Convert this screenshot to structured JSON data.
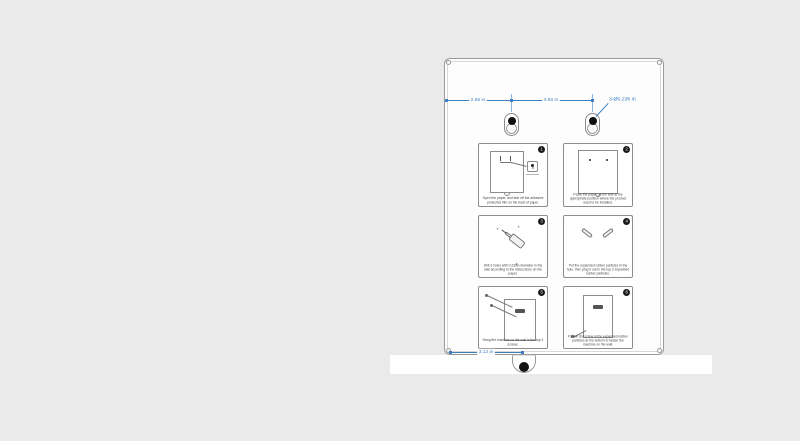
{
  "colors": {
    "page-bg": "#eaeaea",
    "dimension-blue": "#3d7fc1",
    "sheet-border": "#9a9a9a"
  },
  "drawing": {
    "dimensions": {
      "left_spacing": "2.55 in",
      "center_spacing": "3.50 in",
      "hole_callout": "3-Ø0.236 in",
      "bottom_offset": "3.12 in"
    },
    "panels": [
      {
        "number": "1",
        "caption": "Open the paper, and tear off the adhesive protective film on the back of paper."
      },
      {
        "number": "2",
        "caption": "Paste the paper on the wall at the appropriate position where the product need to be installed."
      },
      {
        "number": "3",
        "caption": "Drill 3 holes with 0.236in diameter in the wall according to the instructions on the paper."
      },
      {
        "number": "4",
        "caption": "Put the expanded rubber particles in the hole, then plug it out in the top 2 expanded rubber particles."
      },
      {
        "number": "5",
        "caption": "Hang the machine on the wall in the top 2 screws."
      },
      {
        "number": "6",
        "caption": "Fix the 3rd screw in the expanded rubber particles at the bottom to fasten the machine on the wall."
      }
    ]
  }
}
